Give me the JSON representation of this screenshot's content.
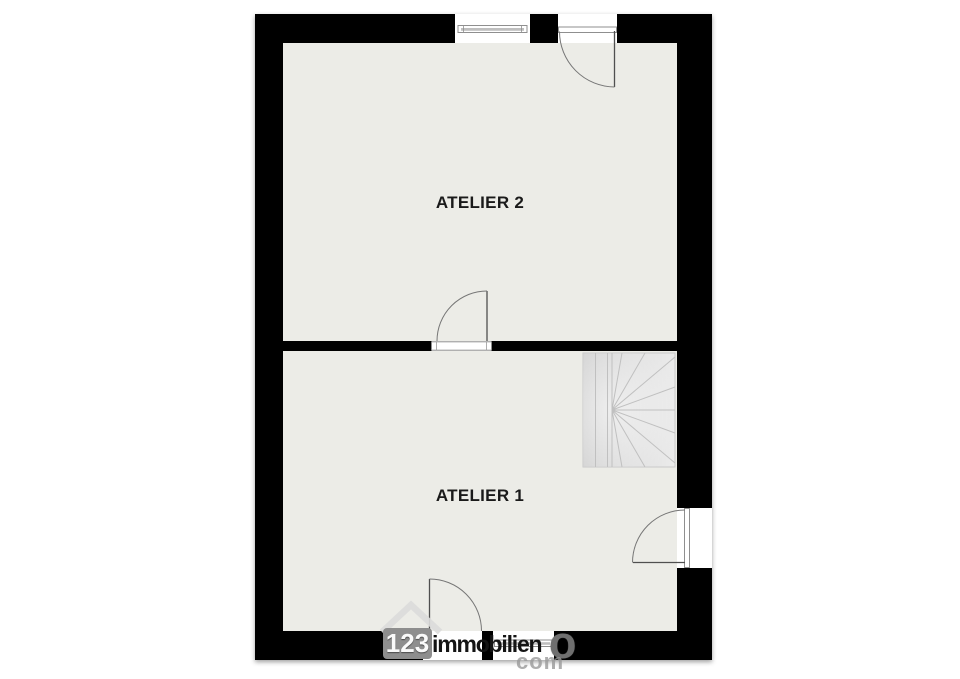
{
  "rooms": [
    {
      "label": "ATELIER 2"
    },
    {
      "label": "ATELIER 1"
    }
  ],
  "watermark": {
    "number": "123",
    "word": "immobilien",
    "trailing_letter": "o",
    "second_line": "com"
  },
  "icons": {
    "house_icon": "house-roof-chevron",
    "stairs_icon": "winder-staircase"
  },
  "colors": {
    "wall": "#060606",
    "floor": "#ecece7",
    "stair_light": "#ebebeb",
    "stair_dark": "#d2d2d2",
    "watermark_badge": "#8e8e8e",
    "label_text": "#1a1a1a"
  }
}
